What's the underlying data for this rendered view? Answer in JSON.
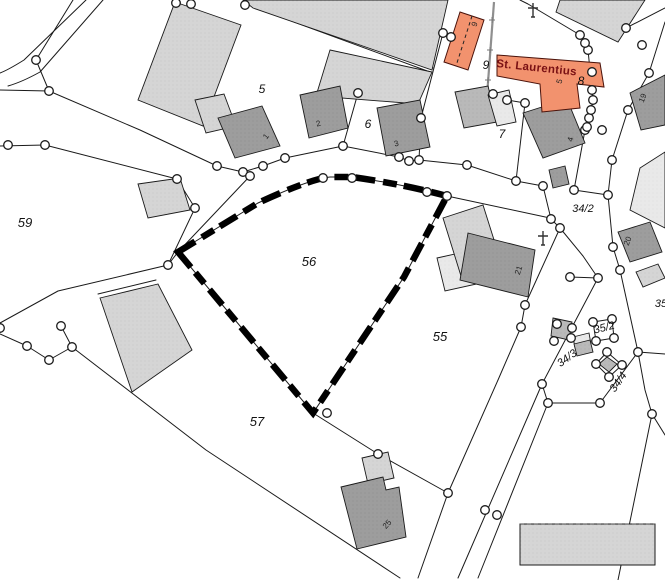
{
  "map": {
    "selected_parcel": "56",
    "church": {
      "name": "St. Laurentius"
    },
    "colors": {
      "line": "#1a1a1a",
      "highlight": "#000000",
      "building_light": "#d5d5d5",
      "building_mid": "#b9b9b9",
      "building_dark": "#9d9d9d",
      "building_pale": "#e9e9e9",
      "church_fill": "#f2926e",
      "church_text": "#7a1114"
    },
    "parcel_labels": [
      {
        "t": "59",
        "x": 25,
        "y": 227,
        "r": 0,
        "s": 13
      },
      {
        "t": "56",
        "x": 309,
        "y": 266,
        "r": 0,
        "s": 13
      },
      {
        "t": "55",
        "x": 440,
        "y": 341,
        "r": 0,
        "s": 13
      },
      {
        "t": "57",
        "x": 257,
        "y": 426,
        "r": 0,
        "s": 13
      },
      {
        "t": "5",
        "x": 262,
        "y": 93,
        "r": 0,
        "s": 12
      },
      {
        "t": "6",
        "x": 368,
        "y": 128,
        "r": 0,
        "s": 12
      },
      {
        "t": "7",
        "x": 502,
        "y": 138,
        "r": 0,
        "s": 12
      },
      {
        "t": "8",
        "x": 581,
        "y": 85,
        "r": 0,
        "s": 12
      },
      {
        "t": "9",
        "x": 486,
        "y": 69,
        "r": 0,
        "s": 12
      },
      {
        "t": "34/2",
        "x": 583,
        "y": 212,
        "r": 0,
        "s": 11
      },
      {
        "t": "34/3",
        "x": 569,
        "y": 361,
        "r": -36,
        "s": 11
      },
      {
        "t": "35/2",
        "x": 605,
        "y": 331,
        "r": -14,
        "s": 11
      },
      {
        "t": "34/4",
        "x": 621,
        "y": 384,
        "r": -55,
        "s": 11
      },
      {
        "t": "35",
        "x": 661,
        "y": 307,
        "r": 0,
        "s": 11
      }
    ],
    "house_numbers": [
      {
        "t": "1",
        "x": 268,
        "y": 138,
        "r": -52
      },
      {
        "t": "2",
        "x": 319,
        "y": 126,
        "r": -15
      },
      {
        "t": "3",
        "x": 397,
        "y": 146,
        "r": -15
      },
      {
        "t": "4",
        "x": 573,
        "y": 140,
        "r": -75
      },
      {
        "t": "5",
        "x": 562,
        "y": 82,
        "r": -75
      },
      {
        "t": "9",
        "x": 477,
        "y": 25,
        "r": -70
      },
      {
        "t": "19",
        "x": 645,
        "y": 99,
        "r": -68
      },
      {
        "t": "20",
        "x": 630,
        "y": 242,
        "r": -68
      },
      {
        "t": "21",
        "x": 521,
        "y": 271,
        "r": -72
      },
      {
        "t": "25",
        "x": 389,
        "y": 526,
        "r": -48
      }
    ],
    "survey_points": [
      [
        36,
        60
      ],
      [
        49,
        91
      ],
      [
        8,
        145
      ],
      [
        45,
        145
      ],
      [
        176,
        3
      ],
      [
        191,
        4
      ],
      [
        245,
        5
      ],
      [
        217,
        166
      ],
      [
        243,
        172
      ],
      [
        250,
        176
      ],
      [
        263,
        166
      ],
      [
        285,
        158
      ],
      [
        177,
        179
      ],
      [
        195,
        208
      ],
      [
        168,
        265
      ],
      [
        343,
        146
      ],
      [
        399,
        157
      ],
      [
        409,
        161
      ],
      [
        419,
        160
      ],
      [
        467,
        165
      ],
      [
        358,
        93
      ],
      [
        443,
        33
      ],
      [
        451,
        37
      ],
      [
        421,
        118
      ],
      [
        493,
        94
      ],
      [
        507,
        100
      ],
      [
        525,
        103
      ],
      [
        516,
        181
      ],
      [
        543,
        186
      ],
      [
        551,
        219
      ],
      [
        560,
        228
      ],
      [
        574,
        190
      ],
      [
        585,
        130
      ],
      [
        587,
        127
      ],
      [
        589,
        118
      ],
      [
        591,
        110
      ],
      [
        593,
        100
      ],
      [
        592,
        90
      ],
      [
        588,
        50
      ],
      [
        585,
        43
      ],
      [
        580,
        35
      ],
      [
        602,
        130
      ],
      [
        608,
        195
      ],
      [
        613,
        247
      ],
      [
        620,
        270
      ],
      [
        628,
        110
      ],
      [
        642,
        45
      ],
      [
        649,
        73
      ],
      [
        612,
        160
      ],
      [
        598,
        278
      ],
      [
        570,
        277
      ],
      [
        638,
        352
      ],
      [
        652,
        414
      ],
      [
        525,
        305
      ],
      [
        521,
        327
      ],
      [
        542,
        384
      ],
      [
        548,
        403
      ],
      [
        600,
        403
      ],
      [
        485,
        510
      ],
      [
        497,
        515
      ],
      [
        448,
        493
      ],
      [
        378,
        454
      ],
      [
        327,
        413
      ],
      [
        323,
        178
      ],
      [
        352,
        178
      ],
      [
        427,
        192
      ],
      [
        447,
        196
      ],
      [
        0,
        328
      ],
      [
        27,
        346
      ],
      [
        49,
        360
      ],
      [
        61,
        326
      ],
      [
        72,
        347
      ],
      [
        592,
        72
      ],
      [
        626,
        28
      ],
      [
        557,
        324
      ],
      [
        572,
        328
      ],
      [
        554,
        341
      ],
      [
        571,
        338
      ],
      [
        593,
        322
      ],
      [
        612,
        319
      ],
      [
        596,
        341
      ],
      [
        614,
        338
      ],
      [
        607,
        352
      ],
      [
        622,
        365
      ],
      [
        609,
        377
      ],
      [
        596,
        364
      ]
    ],
    "crosses": [
      [
        533,
        10
      ],
      [
        543,
        238
      ]
    ],
    "wall_ticks": [
      [
        492,
        20
      ],
      [
        490,
        50
      ],
      [
        488,
        80
      ]
    ]
  }
}
